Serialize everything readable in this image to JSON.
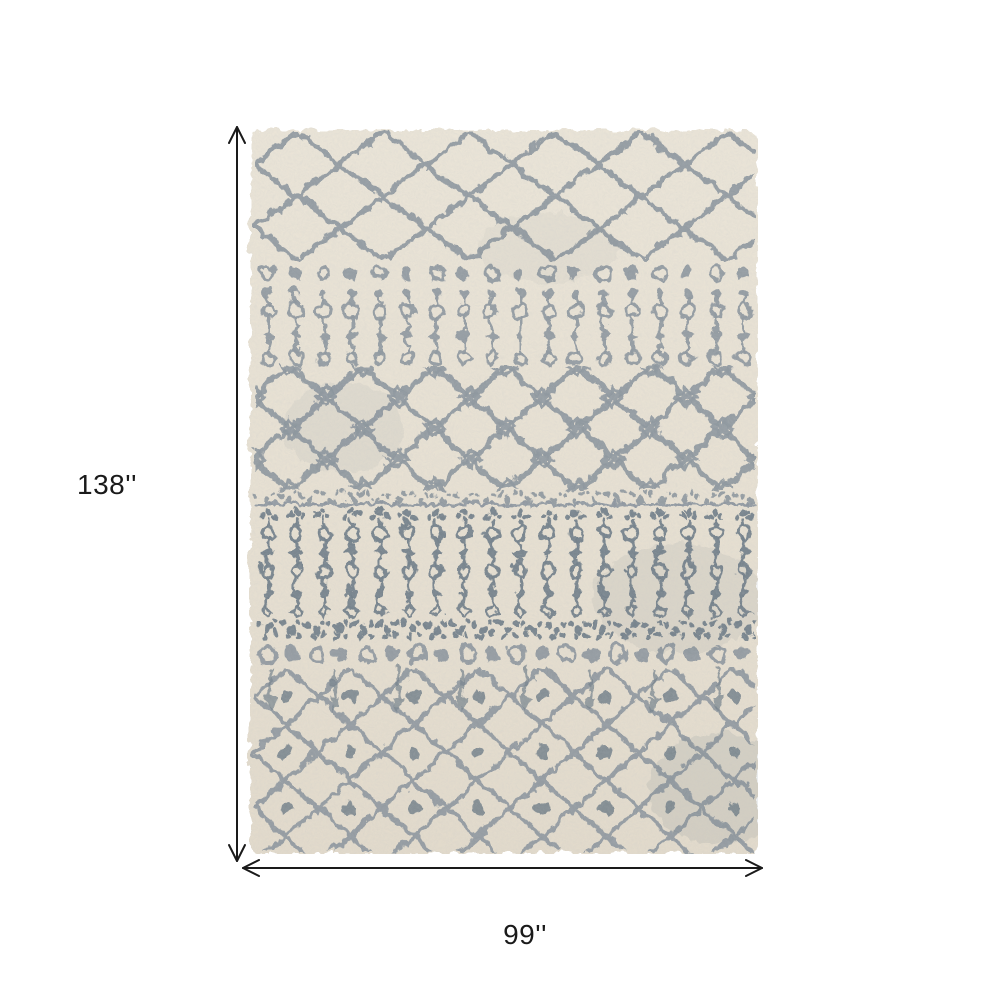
{
  "page": {
    "background": "#ffffff"
  },
  "rug": {
    "description": "Ivory and gray Moroccan-style patterned shag area rug shown flat",
    "pattern_bands": [
      "open trellis lattice",
      "small circle row",
      "beaded column band",
      "ornate trellis with knot diamonds",
      "speckled stripe",
      "dense beaded column band",
      "dense dot rows",
      "trellis lattice with center dots"
    ]
  },
  "colors": {
    "page_bg": "#ffffff",
    "rug_base": "#e7e0d2",
    "pattern_gray": "#8e979f",
    "pattern_gray_dark": "#73808a",
    "annotation": "#1a1a1a"
  },
  "dimensions": {
    "height_label": "138''",
    "width_label": "99''"
  },
  "icons": {
    "height_arrow": "vertical-double-arrow",
    "width_arrow": "horizontal-double-arrow"
  }
}
